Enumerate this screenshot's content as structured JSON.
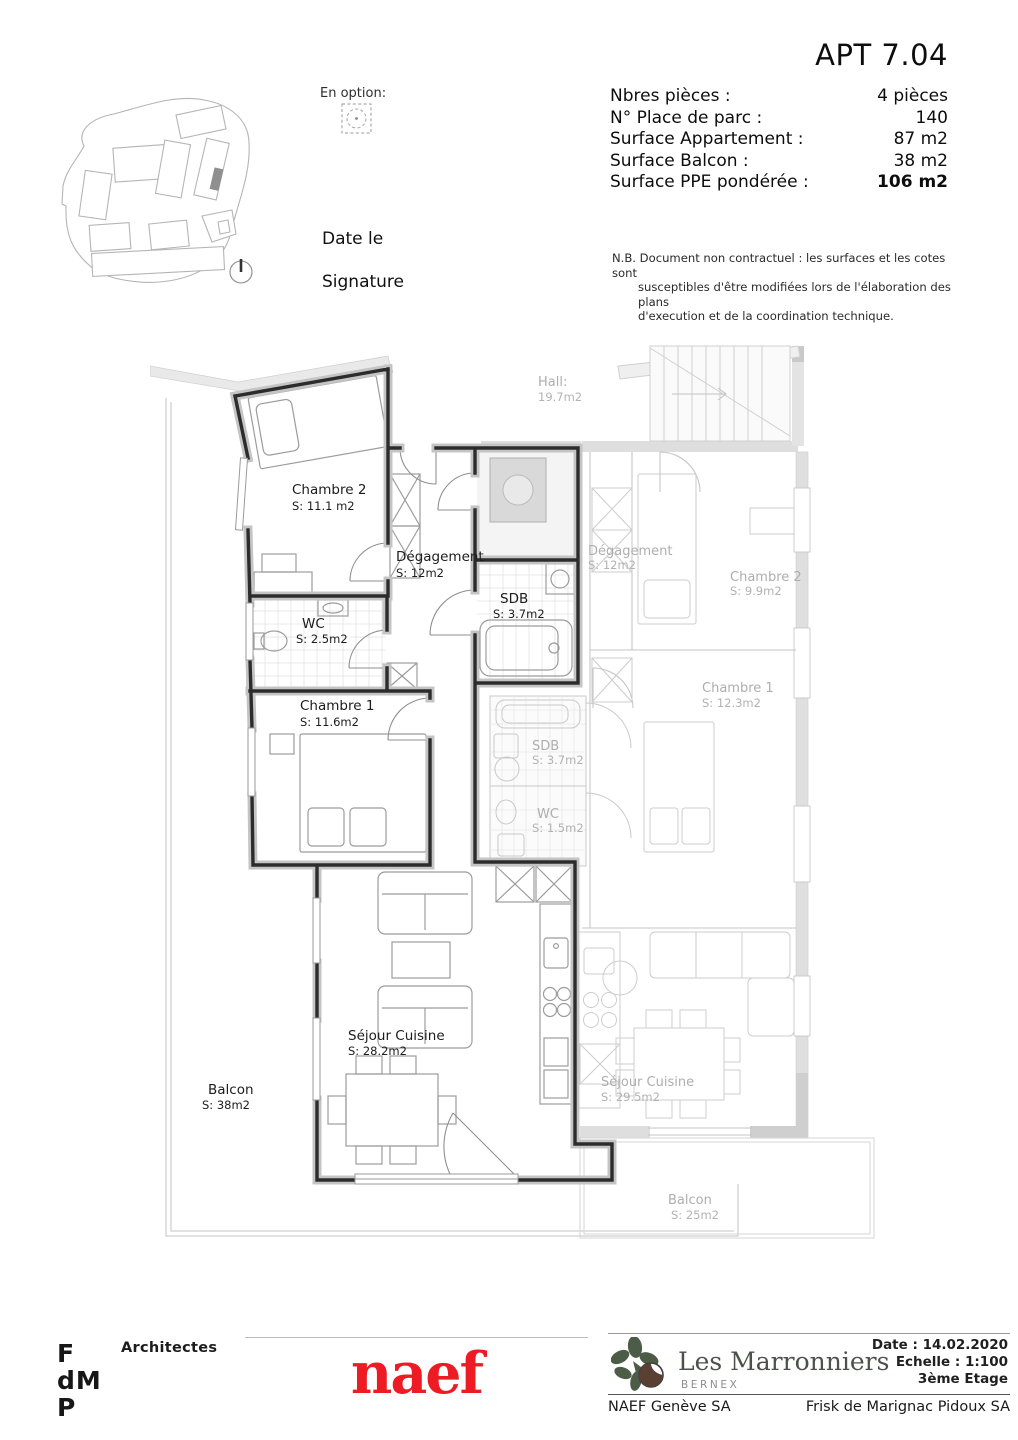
{
  "header": {
    "apt_title": "APT 7.04",
    "fields": [
      {
        "label": "Nbres pièces :",
        "value": "4 pièces"
      },
      {
        "label": "N° Place de parc :",
        "value": "140"
      },
      {
        "label": "Surface Appartement :",
        "value": "87 m2"
      },
      {
        "label": "Surface Balcon :",
        "value": "38 m2"
      },
      {
        "label": "Surface PPE pondérée :",
        "value": "106 m2"
      }
    ],
    "option_label": "En option:",
    "date_label": "Date le",
    "signature_label": "Signature",
    "disclaimer": [
      "N.B. Document non contractuel : les surfaces et les cotes sont",
      "susceptibles d'être modifiées lors de l'élaboration des plans",
      "d'execution et de la coordination technique."
    ]
  },
  "plan": {
    "hall_label": "Hall:",
    "hall_area": "19.7m2",
    "chambre2_label": "Chambre 2",
    "chambre2_area": "S: 11.1 m2",
    "degagement_label": "Dégagement",
    "degagement_area": "S: 12m2",
    "wc_label": "WC",
    "wc_area": "S: 2.5m2",
    "sdb_label": "SDB",
    "sdb_area": "S: 3.7m2",
    "chambre1_label": "Chambre 1",
    "chambre1_area": "S: 11.6m2",
    "sejour_label": "Séjour Cuisine",
    "sejour_area": "S: 28.2m2",
    "balcon_label": "Balcon",
    "balcon_area": "S: 38m2",
    "n_degagement_label": "Dégagement",
    "n_degagement_area": "S: 12m2",
    "n_chambre2_label": "Chambre 2",
    "n_chambre2_area": "S: 9.9m2",
    "n_chambre1_label": "Chambre 1",
    "n_chambre1_area": "S: 12.3m2",
    "n_sdb_label": "SDB",
    "n_sdb_area": "S: 3.7m2",
    "n_wc_label": "WC",
    "n_wc_area": "S: 1.5m2",
    "n_sejour_label": "Séjour Cuisine",
    "n_sejour_area": "S: 29.5m2",
    "n_balcon_label": "Balcon",
    "n_balcon_area": "S: 25m2"
  },
  "footer": {
    "architect_logo_line1": "F",
    "architect_logo_line2": "dM",
    "architect_logo_line3": "P",
    "architects_label": "Architectes",
    "naef_logo": "naef",
    "project_name": "Les Marronniers",
    "project_location": "BERNEX",
    "date": "Date : 14.02.2020",
    "scale": "Echelle : 1:100",
    "floor": "3ème Etage",
    "left_company": "NAEF Genève SA",
    "right_company": "Frisk de Marignac Pidoux SA"
  },
  "colors": {
    "naef_red": "#ED1C24",
    "leaf_green": "#4D5C46",
    "chestnut_brown": "#5A4032",
    "wall_dark": "#2C2C2C",
    "faded_gray": "#ADADAD"
  }
}
